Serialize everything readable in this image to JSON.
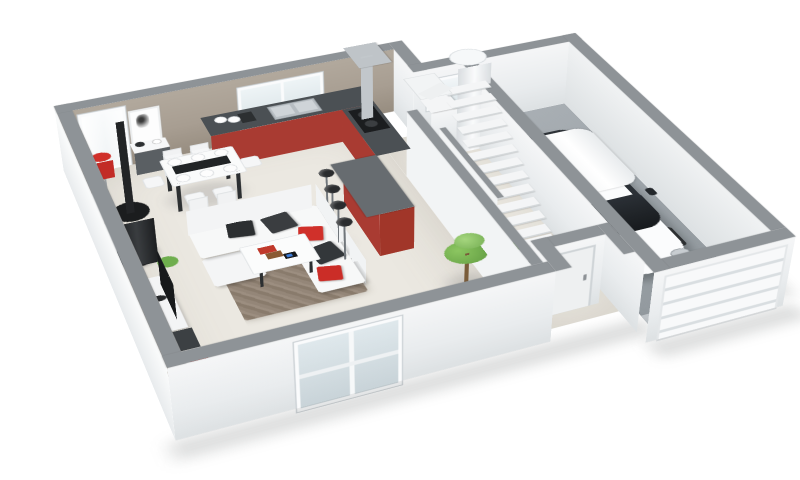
{
  "meta": {
    "title": "3D perspective cutaway floor plan — ground floor of a house with attached single garage",
    "view": "perspective-cutaway-3d"
  },
  "palette": {
    "wallTop": "#8e9397",
    "wallWhite": "#f2f4f5",
    "wallTaupe": "#a89e92",
    "floorCream": "#ebe8e1",
    "floorGarage": "#9aa1a6",
    "kitchenRed": "#a93b32",
    "counterDark": "#4b5054",
    "accentRed": "#d0302a",
    "sofaWhite": "#f7f8f8",
    "rugBrown": "#8d7f70",
    "carWhite": "#fbfcfd",
    "glassDark": "#2e3338",
    "plantGreen": "#6fae4e",
    "bikeTan": "#c9a34d",
    "stainless": "#bfc4c8"
  },
  "scene": {
    "rooms": [
      {
        "id": "living-dining",
        "floor": "cream-tile"
      },
      {
        "id": "kitchen",
        "cabinets": "red",
        "countertop": "dark-gray"
      },
      {
        "id": "entry-hall",
        "features": [
          "front-door",
          "entry-cabinet",
          "potted-plant"
        ]
      },
      {
        "id": "stairwell",
        "stairs": "white-L-shaped-winder"
      },
      {
        "id": "utility-nook",
        "features": [
          "water-heater-cylinder",
          "small-window",
          "appliance-box"
        ]
      },
      {
        "id": "garage",
        "floor": "concrete-gray",
        "features": [
          "white-car",
          "bicycle",
          "soccer-ball",
          "sectional-garage-door"
        ]
      }
    ],
    "objects": [
      "l-shaped-white-sofa",
      "red-and-black-cushions",
      "ottoman",
      "coffee-table-with-books-and-tablet",
      "brown-rug",
      "flat-tv-on-bench",
      "av-cabinet",
      "wood-stove-with-flue",
      "red-floor-lamp",
      "red-table-lamp",
      "dining-table-6-chairs",
      "place-settings",
      "sideboard-with-vase",
      "framed-wall-picture",
      "kitchen-counter-with-sink",
      "cooktop-with-range-hood",
      "bar-counter",
      "bar-stools-x4",
      "white-staircase",
      "water-heater",
      "potted-plants",
      "white-hatchback-car",
      "yellow-bicycle",
      "soccer-ball",
      "garage-door",
      "sliding-glass-door",
      "front-door",
      "windows-with-sheer-curtains"
    ],
    "counts": {
      "bar_stools": 4,
      "dining_chairs": 6,
      "cars": 1,
      "bicycles": 1
    }
  }
}
